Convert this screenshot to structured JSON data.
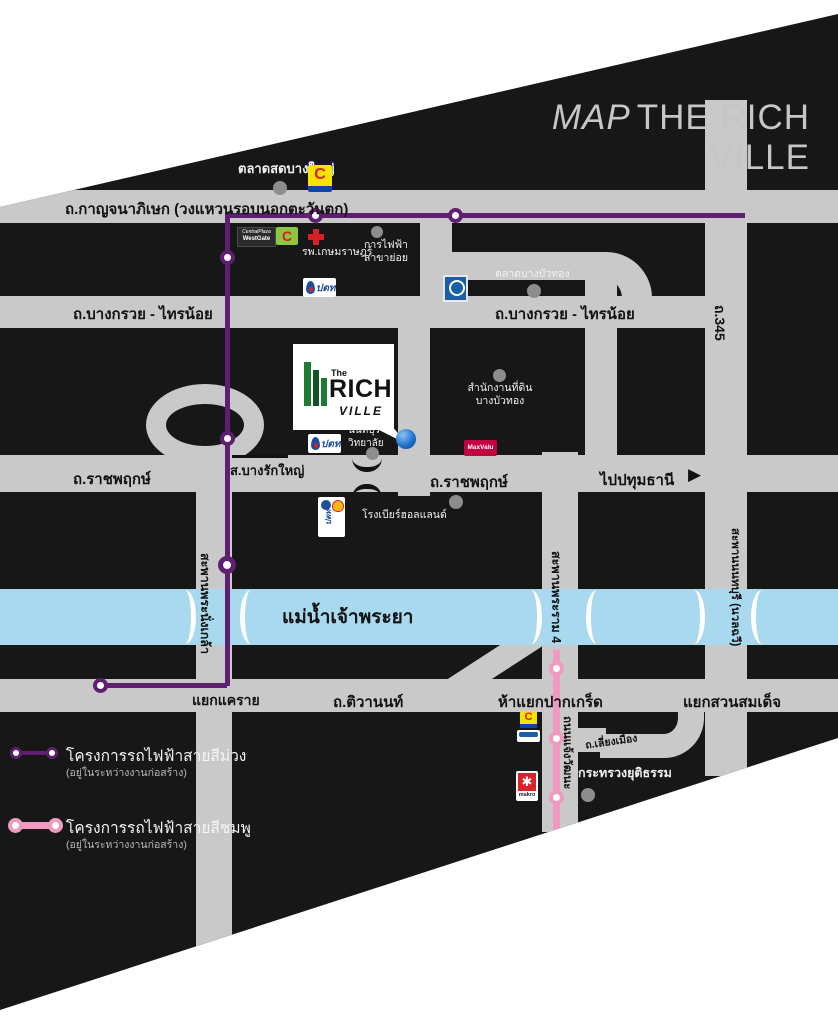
{
  "title": {
    "prefix": "MAP",
    "name": "THE RICH VILLE"
  },
  "river": {
    "label": "แม่น้ำเจ้าพระยา",
    "color": "#a9d9ef"
  },
  "roads": {
    "kanchanaphisek": "ถ.กาญจนาภิเษก (วงแหวนรอบนอกตะวันตก)",
    "bangkruai_left": "ถ.บางกรวย - ไทรน้อย",
    "bangkruai_right": "ถ.บางกรวย - ไทรน้อย",
    "ratchaphruek_left": "ถ.ราชพฤกษ์",
    "ratchaphruek_right": "ถ.ราชพฤกษ์",
    "tiwanon": "ถ.ติวานนท์",
    "route_345": "ถ.345",
    "liang_mueang": "ถ.เลี่ยงเมือง",
    "chaeng_watthana": "ถนนแจ้งวัฒนะ",
    "to_pathumthani": "ไปปทุมธานี",
    "to_pathumthani_arrow": "▶"
  },
  "bridges": {
    "phra_nangklao": "สะพานพระนั่งเกล้า",
    "rama_4": "สะพานพระราม 4",
    "nonthaburi": "สะพานนนทบุรี (นวลฉวี)"
  },
  "junctions": {
    "khae_rai": "แยกแคราย",
    "pak_kret": "ห้าแยกปากเกร็ด",
    "suan_somdet": "แยกสวนสมเด็จ",
    "bang_rak_yai_station": "ส.บางรักใหญ่"
  },
  "places": {
    "talat_bang_yai": "ตลาดสดบางใหญ่",
    "kasemrad_hospital": "รพ.เกษมราษฎร์",
    "electricity_1": "การไฟฟ้า",
    "electricity_2": "สาขาย่อย",
    "talat_bang_bua_thong": "ตลาดบางบัวทอง",
    "land_office_1": "สำนักงานที่ดิน",
    "land_office_2": "บางบัวทอง",
    "college_1": "นนทบุรี",
    "college_2": "วิทยาลัย",
    "holland_beer": "โรงเบียร์ฮอลแลนด์",
    "ministry_justice": "กระทรวงยุติธรรม"
  },
  "legend": {
    "purple": {
      "label": "โครงการรถไฟฟ้าสายสีม่วง",
      "note": "(อยู่ในระหว่างงานก่อสร้าง)",
      "color": "#5e1f70"
    },
    "pink": {
      "label": "โครงการรถไฟฟ้าสายสีชมพู",
      "note": "(อยู่ในระหว่างงานก่อสร้าง)",
      "color": "#f09abf"
    }
  },
  "logos": {
    "richville": {
      "the": "The",
      "rich": "RICH",
      "ville": "VILLE"
    },
    "maxvalu": "MaxValu",
    "bigc_glyph": "C",
    "central_1": "CentralPlaza",
    "central_2": "WestGate",
    "ptt": "ปตท",
    "makro": "makro"
  },
  "colors": {
    "map_bg": "#171717",
    "road": "#c9c9c9",
    "purple": "#5e1f70",
    "pink": "#f09abf",
    "river": "#a9d9ef",
    "marker_blue": "#1f74d0",
    "dot_gray": "#8d8d8d",
    "title_gray": "#c6c6c6"
  }
}
